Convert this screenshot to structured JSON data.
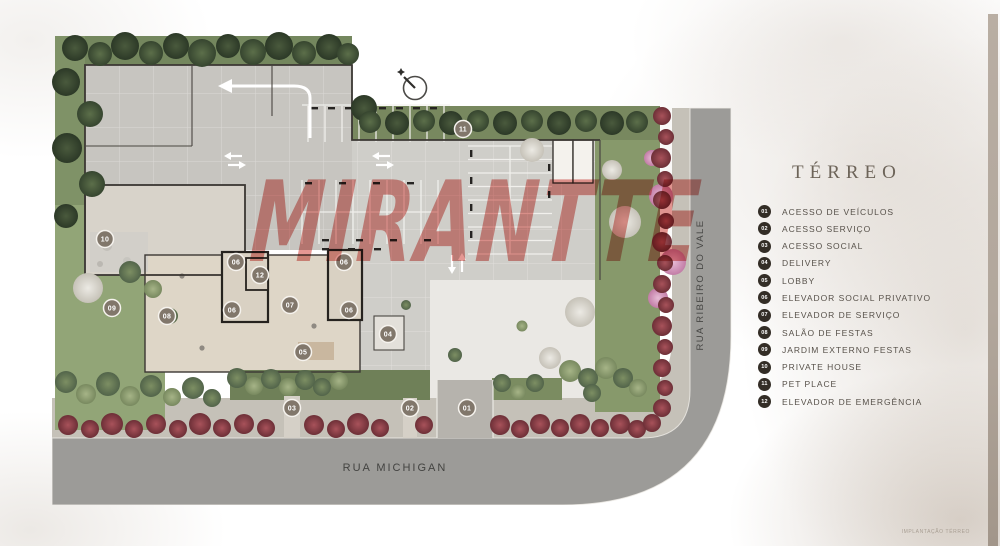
{
  "watermark_text": "MIRANTTE",
  "plan": {
    "street_bottom_label": "RUA MICHIGAN",
    "street_right_label": "RUA RIBEIRO DO VALE",
    "markers": [
      {
        "num": "01",
        "x": 415,
        "y": 382
      },
      {
        "num": "02",
        "x": 358,
        "y": 382
      },
      {
        "num": "03",
        "x": 240,
        "y": 382
      },
      {
        "num": "04",
        "x": 336,
        "y": 308
      },
      {
        "num": "05",
        "x": 251,
        "y": 326
      },
      {
        "num": "06",
        "x": 184,
        "y": 236
      },
      {
        "num": "06",
        "x": 292,
        "y": 236
      },
      {
        "num": "06",
        "x": 180,
        "y": 284
      },
      {
        "num": "06",
        "x": 297,
        "y": 284
      },
      {
        "num": "07",
        "x": 238,
        "y": 279
      },
      {
        "num": "08",
        "x": 115,
        "y": 290
      },
      {
        "num": "09",
        "x": 60,
        "y": 282
      },
      {
        "num": "10",
        "x": 53,
        "y": 213
      },
      {
        "num": "11",
        "x": 411,
        "y": 103
      },
      {
        "num": "12",
        "x": 208,
        "y": 249
      }
    ]
  },
  "legend": {
    "title": "TÉRREO",
    "items": [
      {
        "num": "01",
        "label": "ACESSO DE VEÍCULOS"
      },
      {
        "num": "02",
        "label": "ACESSO SERVIÇO"
      },
      {
        "num": "03",
        "label": "ACESSO SOCIAL"
      },
      {
        "num": "04",
        "label": "DELIVERY"
      },
      {
        "num": "05",
        "label": "LOBBY"
      },
      {
        "num": "06",
        "label": "ELEVADOR SOCIAL PRIVATIVO"
      },
      {
        "num": "07",
        "label": "ELEVADOR DE SERVIÇO"
      },
      {
        "num": "08",
        "label": "SALÃO DE FESTAS"
      },
      {
        "num": "09",
        "label": "JARDIM EXTERNO FESTAS"
      },
      {
        "num": "10",
        "label": "PRIVATE HOUSE"
      },
      {
        "num": "11",
        "label": "PET PLACE"
      },
      {
        "num": "12",
        "label": "ELEVADOR DE EMERGÊNCIA"
      }
    ]
  },
  "caption": "IMPLANTAÇÃO TÉRREO",
  "icons": {
    "compass": "north-compass-icon"
  },
  "colors": {
    "watermark_red": "#cd372f",
    "legend_badge": "#332d26",
    "plan_marker_badge": "#81776b",
    "plan_marker_ring": "#f6f3ee",
    "street_gray": "#9c9b98",
    "lawn_green": "#8da073",
    "hedge_red": "#8c424a",
    "edge_bar_taupe": "#b2a79c"
  }
}
